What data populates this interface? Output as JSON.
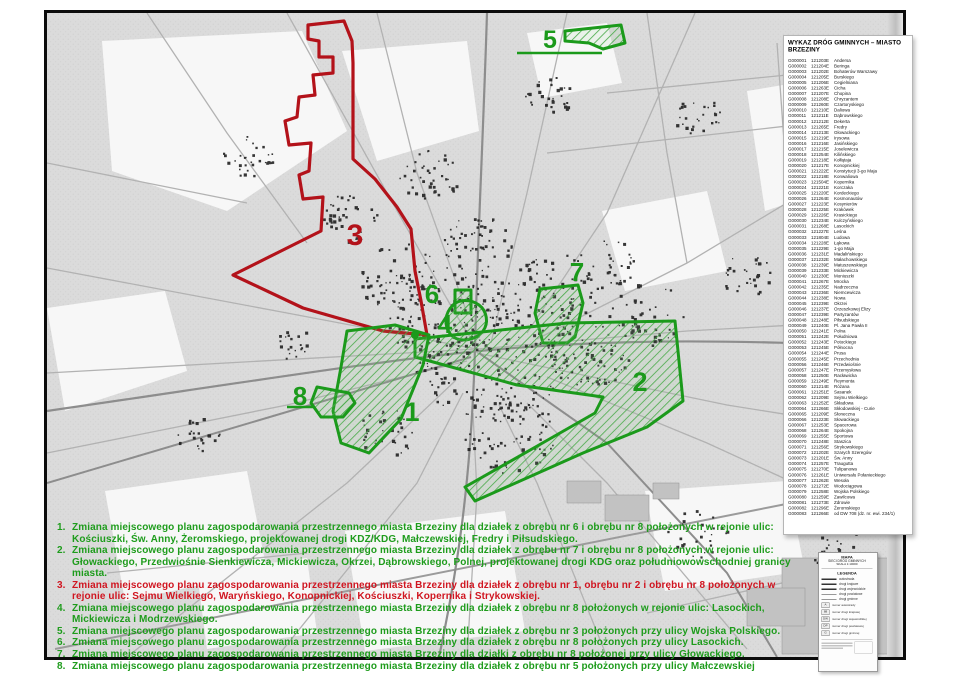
{
  "map": {
    "zones": [
      {
        "label": "1",
        "color": "#1b9a1b"
      },
      {
        "label": "2",
        "color": "#1b9a1b"
      },
      {
        "label": "3",
        "color": "#b3121a"
      },
      {
        "label": "4",
        "color": "#1b9a1b"
      },
      {
        "label": "5",
        "color": "#1b9a1b"
      },
      {
        "label": "6",
        "color": "#1b9a1b"
      },
      {
        "label": "7",
        "color": "#1b9a1b"
      },
      {
        "label": "8",
        "color": "#1b9a1b"
      }
    ],
    "colors": {
      "green": "#1b9a1b",
      "red": "#b3121a",
      "base": "#dbdbdb",
      "road": "#b2b2b2",
      "building": "#1c1c1c"
    }
  },
  "roads_panel": {
    "title": "WYKAZ DRÓG GMINNYCH – MIASTO BRZEZINY",
    "rows": [
      [
        "G000001",
        "121203E",
        "Andersa"
      ],
      [
        "G000002",
        "121204E",
        "Beringa"
      ],
      [
        "G000003",
        "121202E",
        "Bohaterów Warszawy"
      ],
      [
        "G000004",
        "121205E",
        "Burskiego"
      ],
      [
        "G000005",
        "121206E",
        "Cegielniana"
      ],
      [
        "G000006",
        "121263E",
        "Cicha"
      ],
      [
        "G000007",
        "121207E",
        "Chopina"
      ],
      [
        "G000008",
        "121208E",
        "Chryzantem"
      ],
      [
        "G000009",
        "121260E",
        "Czartoryskiego"
      ],
      [
        "G000010",
        "121210E",
        "Daliowa"
      ],
      [
        "G000011",
        "121211E",
        "Dąbrowskiego"
      ],
      [
        "G000012",
        "121212E",
        "Dekerta"
      ],
      [
        "G000013",
        "121265E",
        "Fredry"
      ],
      [
        "G000014",
        "121213E",
        "Głowackiego"
      ],
      [
        "G000015",
        "121219E",
        "Irysowa"
      ],
      [
        "G000016",
        "121216E",
        "Jasińskiego"
      ],
      [
        "G000017",
        "121215E",
        "Joselewicza"
      ],
      [
        "G000018",
        "121254E",
        "Kilińskiego"
      ],
      [
        "G000019",
        "121218E",
        "Kołłątaja"
      ],
      [
        "G000020",
        "121217E",
        "Konopnickiej"
      ],
      [
        "G000021",
        "121222E",
        "Konstytucji 3-go Maja"
      ],
      [
        "G000022",
        "121218E",
        "Konwaliowa"
      ],
      [
        "G000023",
        "121504E",
        "Kopernika"
      ],
      [
        "G000024",
        "121221E",
        "Korczaka"
      ],
      [
        "G000025",
        "121220E",
        "Kordeckiego"
      ],
      [
        "G000026",
        "121264E",
        "Kosmonautów"
      ],
      [
        "G000027",
        "121223E",
        "Kosynierów"
      ],
      [
        "G000028",
        "121225E",
        "Krakówek"
      ],
      [
        "G000029",
        "121226E",
        "Krasickiego"
      ],
      [
        "G000030",
        "121234E",
        "Kulczyńskiego"
      ],
      [
        "G000031",
        "121268E",
        "Lasockich"
      ],
      [
        "G000032",
        "121227E",
        "Leśna"
      ],
      [
        "G000033",
        "121804E",
        "Ludowa"
      ],
      [
        "G000034",
        "121228E",
        "Łąkowa"
      ],
      [
        "G000035",
        "121229E",
        "1-go Maja"
      ],
      [
        "G000036",
        "121231E",
        "Madalińskiego"
      ],
      [
        "G000037",
        "121232E",
        "Małachowskiego"
      ],
      [
        "G000038",
        "121239E",
        "Matuszewskiego"
      ],
      [
        "G000039",
        "121233E",
        "Mickiewicza"
      ],
      [
        "G000040",
        "121230E",
        "Moniuszki"
      ],
      [
        "G000041",
        "121267E",
        "Mrocka"
      ],
      [
        "G000042",
        "121235E",
        "Nadrzeczna"
      ],
      [
        "G000043",
        "121236E",
        "Niemcewicza"
      ],
      [
        "G000044",
        "121238E",
        "Nowa"
      ],
      [
        "G000045",
        "121239E",
        "Okrzei"
      ],
      [
        "G000046",
        "121237E",
        "Orzeszkowej Elizy"
      ],
      [
        "G000047",
        "121239E",
        "Partyzantów"
      ],
      [
        "G000048",
        "121248E",
        "Piłsudskiego"
      ],
      [
        "G000049",
        "121240E",
        "Pl. Jana Pawła II"
      ],
      [
        "G000050",
        "121241E",
        "Polna"
      ],
      [
        "G000051",
        "121242E",
        "Południowa"
      ],
      [
        "G000052",
        "121243E",
        "Potockiego"
      ],
      [
        "G000053",
        "121245E",
        "Północna"
      ],
      [
        "G000054",
        "121244E",
        "Prusa"
      ],
      [
        "G000055",
        "121245E",
        "Przechodnia"
      ],
      [
        "G000056",
        "121246E",
        "Przedwiośnie"
      ],
      [
        "G000057",
        "121247E",
        "Przemysłowa"
      ],
      [
        "G000058",
        "121250E",
        "Racławicka"
      ],
      [
        "G000059",
        "121249E",
        "Reymonta"
      ],
      [
        "G000060",
        "121214E",
        "Różana"
      ],
      [
        "G000061",
        "121251E",
        "Sasanek"
      ],
      [
        "G000062",
        "121209E",
        "Sejmu Wielkiego"
      ],
      [
        "G000063",
        "121252E",
        "Składowa"
      ],
      [
        "G000064",
        "121266E",
        "Skłodowskiej - Curie"
      ],
      [
        "G000065",
        "121209E",
        "Słoneczna"
      ],
      [
        "G000066",
        "121223E",
        "Słowackiego"
      ],
      [
        "G000067",
        "121253E",
        "Spacerowa"
      ],
      [
        "G000068",
        "121264E",
        "Spokojna"
      ],
      [
        "G000069",
        "121255E",
        "Sportowa"
      ],
      [
        "G000070",
        "121248E",
        "Staszica"
      ],
      [
        "G000071",
        "121256E",
        "Strykowskiego"
      ],
      [
        "G000072",
        "121202E",
        "Szarych Szeregów"
      ],
      [
        "G000073",
        "121201E",
        "Św. Anny"
      ],
      [
        "G000074",
        "121257E",
        "Traugutta"
      ],
      [
        "G000075",
        "121270E",
        "Tulipanowa"
      ],
      [
        "G000076",
        "121261E",
        "Uniwersału Połanieckiego"
      ],
      [
        "G000077",
        "121262E",
        "Wesoła"
      ],
      [
        "G000078",
        "121272E",
        "Wodociągowa"
      ],
      [
        "G000079",
        "121258E",
        "Wojska Polskiego"
      ],
      [
        "G000080",
        "121259E",
        "Zawilcowa"
      ],
      [
        "G000081",
        "121273E",
        "Zdrowie"
      ],
      [
        "G000082",
        "121296E",
        "Żeromskiego"
      ],
      [
        "G000083",
        "121266E",
        "od DW 708 (dz. nr. ewi. 234/1)"
      ]
    ]
  },
  "legend": {
    "header": [
      "MAPA",
      "SIECI DRÓG GMINNYCH",
      "SKALA 1:10000"
    ],
    "title": "LEGENDA",
    "line_items": [
      "autostrada",
      "drogi krajowe",
      "drogi wojewódzkie",
      "drogi powiatowe",
      "drogi gminne"
    ],
    "symbol_items": [
      {
        "sym": "A",
        "label": "numer autostrady"
      },
      {
        "sym": "88",
        "label": "numer drogi krajowej"
      },
      {
        "sym": "DW",
        "label": "numer drogi wojewódzkiej"
      },
      {
        "sym": "DP",
        "label": "numer drogi powiatowej"
      },
      {
        "sym": "G",
        "label": "numer drogi gminnej"
      }
    ]
  },
  "notes": {
    "items": [
      {
        "num": "1.",
        "color": "#1e9c1c",
        "text": "Zmiana miejscowego planu zagospodarowania przestrzennego miasta Brzeziny dla działek z obrębu nr 6 i obrębu nr 8 położonych w rejonie ulic: Kościuszki, Św. Anny, Żeromskiego, projektowanej drogi KDZ/KDG, Małczewskiej, Fredry i Piłsudskiego."
      },
      {
        "num": "2.",
        "color": "#1e9c1c",
        "text": "Zmiana miejscowego planu zagospodarowania przestrzennego miasta Brzeziny dla działek z obrębu nr 7 i obrębu nr 8 położonych w rejonie ulic: Głowackiego, Przedwiośnie Sienkiewicza, Mickiewicza, Okrzei, Dąbrowskiego, Polnej, projektowanej drogi KDG oraz południowowschodniej granicy miasta."
      },
      {
        "num": "3.",
        "color": "#d01520",
        "text": "Zmiana miejscowego planu zagospodarowania przestrzennego miasta Brzeziny dla działek z obrębu nr 1, obrębu nr 2 i obrębu nr 8 położonych w rejonie ulic: Sejmu Wielkiego, Waryńskiego, Konopnickiej, Kościuszki, Kopernika i Strykowskiej."
      },
      {
        "num": "4.",
        "color": "#1e9c1c",
        "text": "Zmiana miejscowego planu zagospodarowania przestrzennego miasta Brzeziny dla działek z obrębu nr 8 położonych w rejonie ulic: Lasockich, Mickiewicza i Modrzewskiego."
      },
      {
        "num": "5.",
        "color": "#1e9c1c",
        "text": "Zmiana miejscowego planu zagospodarowania przestrzennego miasta Brzeziny dla działek z obrębu nr 3 położonych przy ulicy Wojska Polskiego."
      },
      {
        "num": "6.",
        "color": "#1e9c1c",
        "text": "Zmiana miejscowego planu zagospodarowania przestrzennego miasta Brzeziny dla działek z obrębu nr 8 położonych przy ulicy Lasockich."
      },
      {
        "num": "7.",
        "color": "#1e9c1c",
        "text": "Zmiana miejscowego planu zagospodarowania przestrzennego miasta Brzeziny dla działki z obrębu nr 8 położonej przy ulicy Głowackiego."
      },
      {
        "num": "8.",
        "color": "#1e9c1c",
        "text": "Zmiana miejscowego planu zagospodarowania przestrzennego miasta Brzeziny dla działek z obrębu nr 5 położonych przy ulicy Małczewskiej"
      }
    ]
  }
}
